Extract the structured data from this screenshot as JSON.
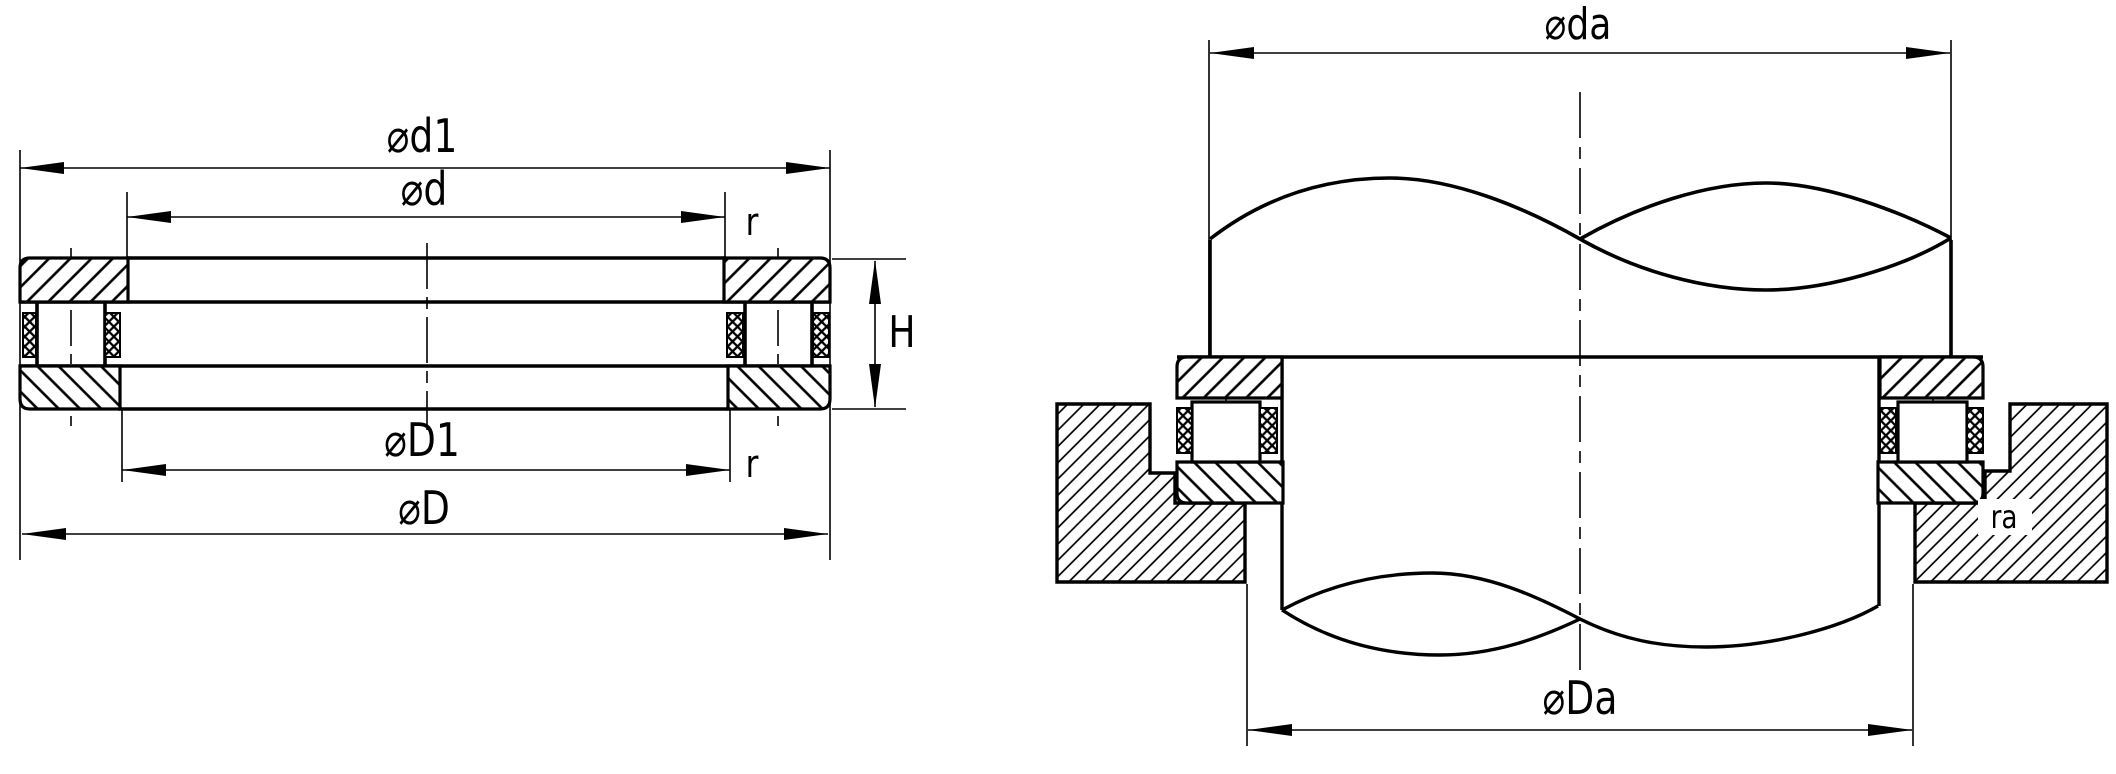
{
  "drawing": {
    "title": "Thrust bearing cross-section and mounting arrangement drawing",
    "colors": {
      "line": "#000000",
      "background": "#ffffff"
    },
    "left_view": {
      "name": "bearing-cross-section-view",
      "labels": {
        "d1": "⌀d1",
        "d": "⌀d",
        "D1": "⌀D1",
        "D": "⌀D",
        "height": "H",
        "r_top": "r",
        "r_bottom": "r"
      }
    },
    "right_view": {
      "name": "shaft-and-housing-mounting-view",
      "labels": {
        "da": "⌀da",
        "Da": "⌀Da",
        "ra": "ra"
      }
    }
  }
}
